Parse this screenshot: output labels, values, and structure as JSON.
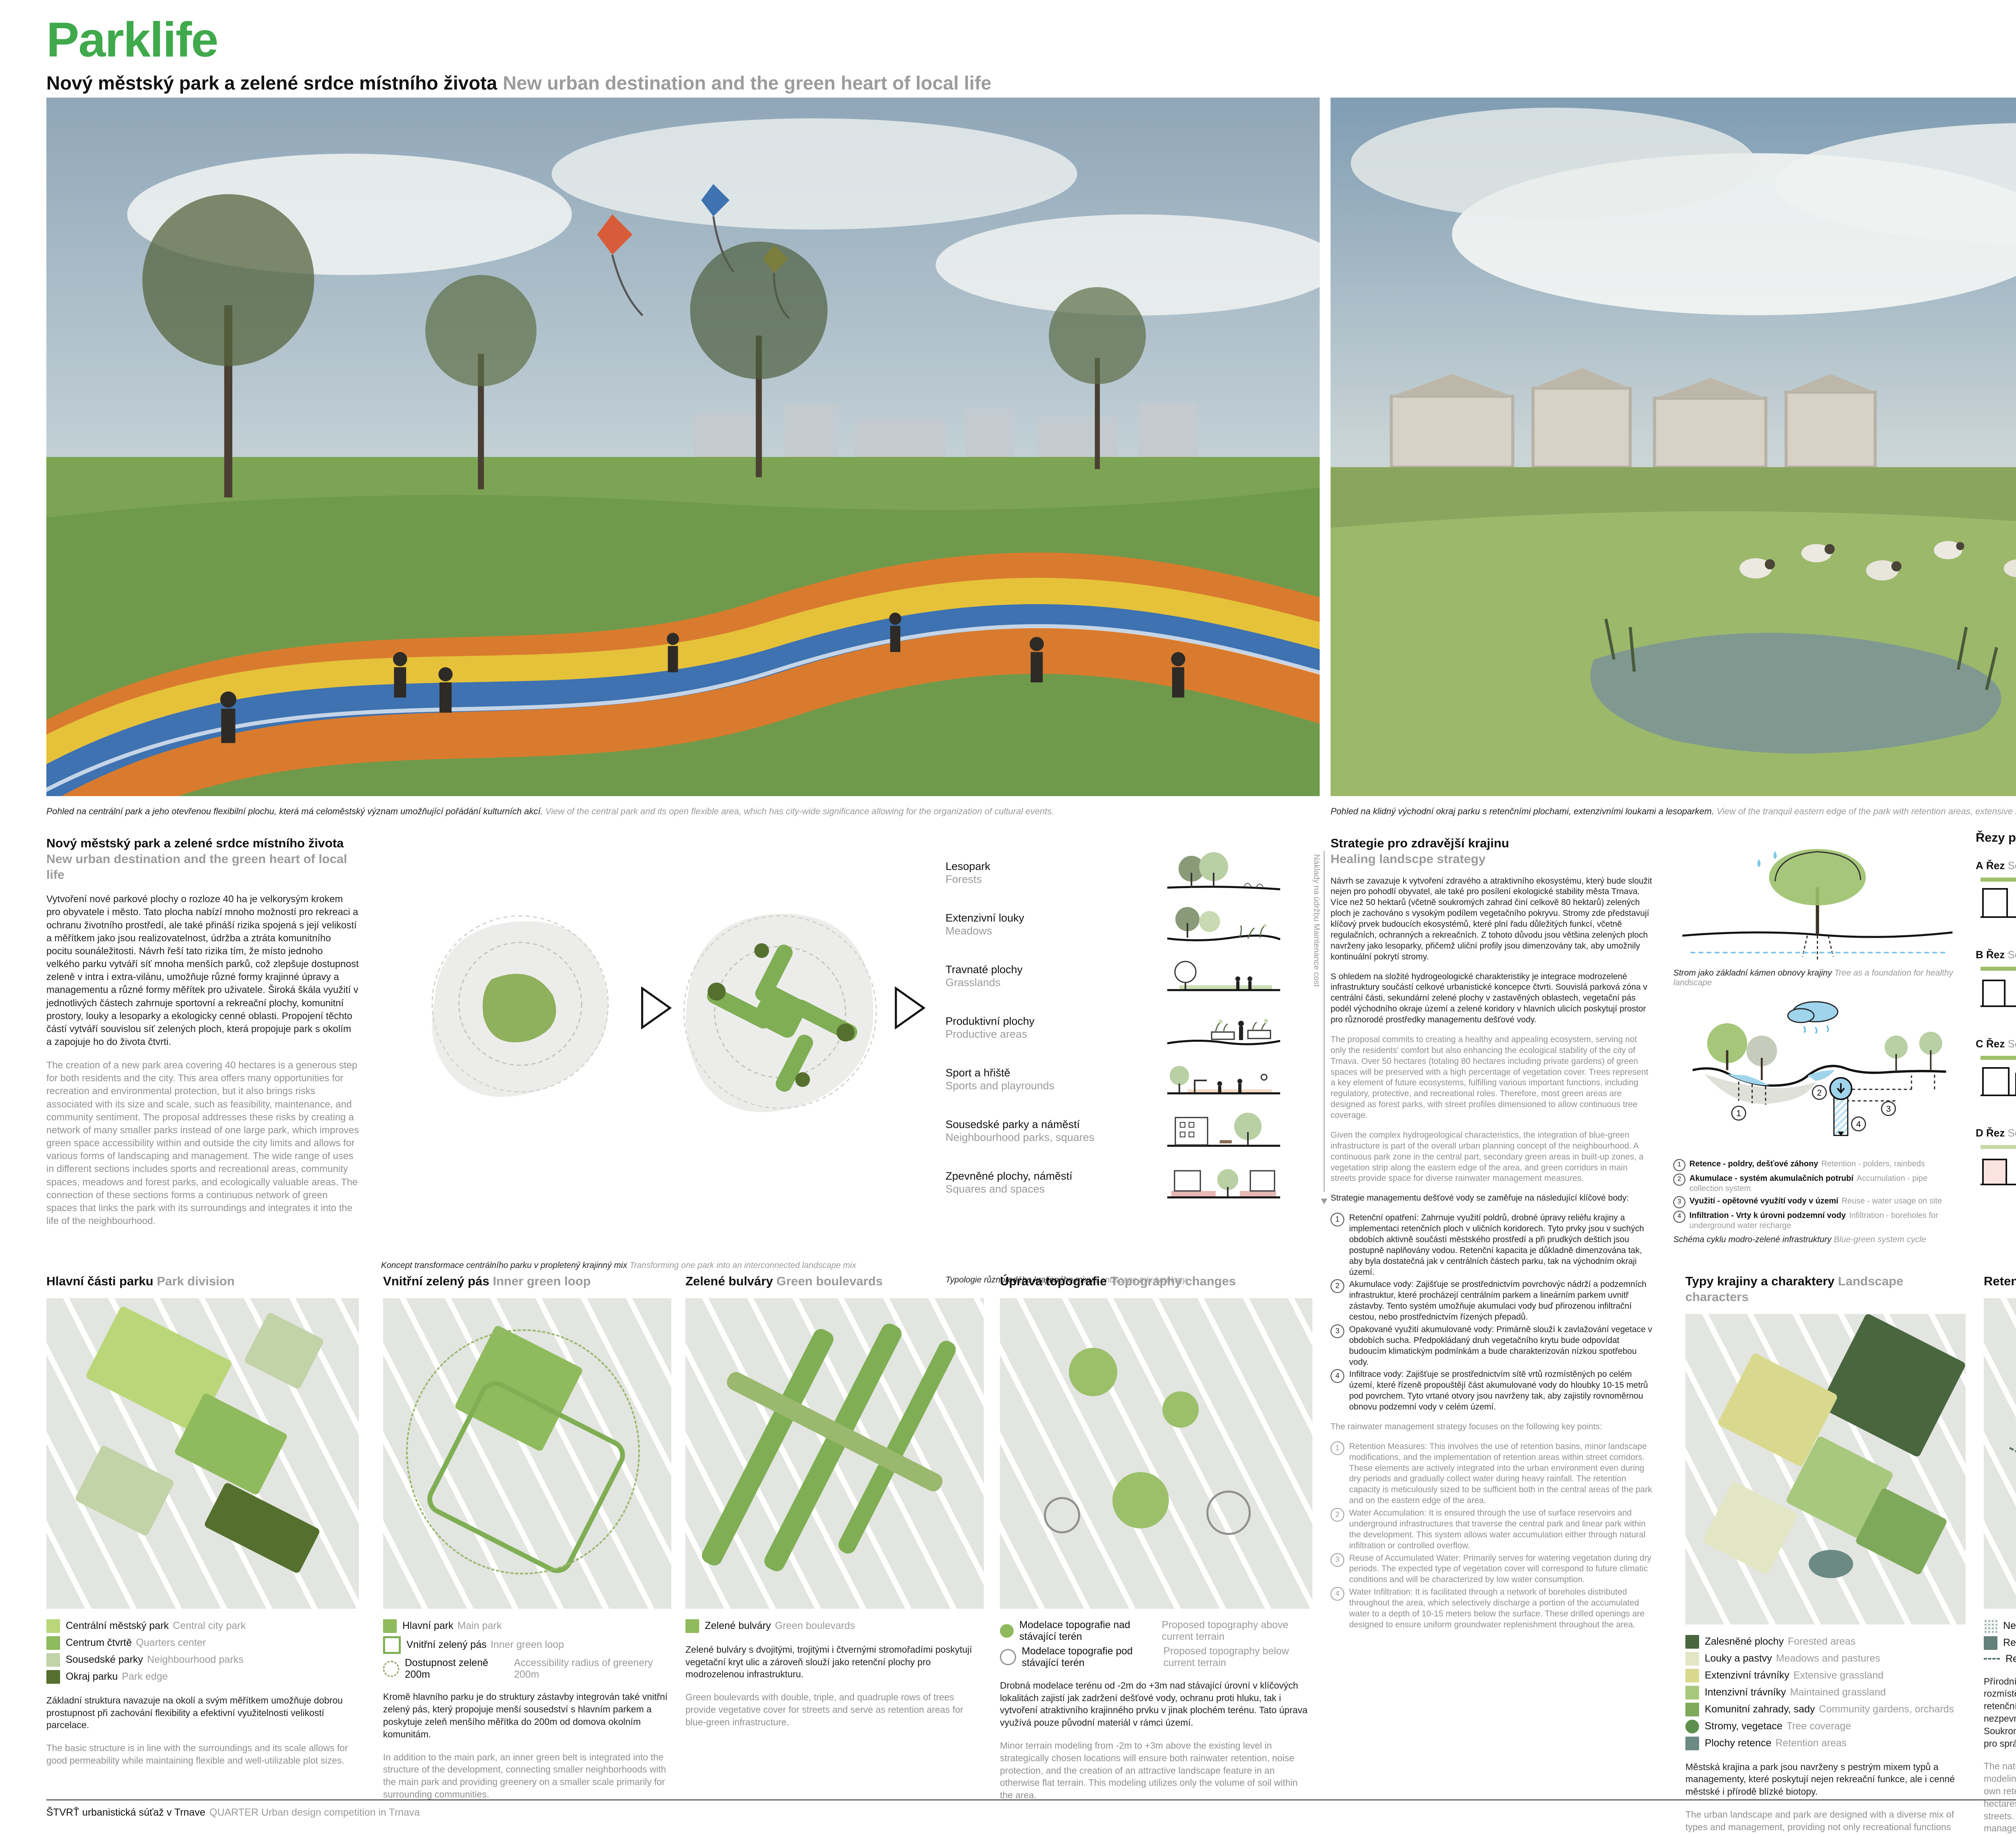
{
  "page": {
    "title": "Parklife",
    "page_number": "4/6",
    "subtitle_cz": "Nový městský park a zelené srdce místního života",
    "subtitle_en": "New urban destination and the green heart of local life"
  },
  "colors": {
    "accent_green": "#3fa94b",
    "park_light": "#b9d778",
    "park_mid": "#8fba5d",
    "park_pale": "#c2d3a8",
    "park_dark": "#55702e",
    "retention_teal": "#64807a",
    "water_blue": "#9fd4ec"
  },
  "hero": {
    "left_caption_cz": "Pohled na centrální park a jeho otevřenou flexibilní plochu, která má celoměstský význam umožňující pořádání kulturních akcí.",
    "left_caption_en": "View of the central park and its open flexible area, which has city-wide significance allowing for the organization of cultural events.",
    "right_caption_cz": "Pohled na klidný východní okraj parku s retenčními plochami, extenzivními loukami a lesoparkem.",
    "right_caption_en": "View of the tranquil eastern edge of the park with retention areas, extensive meadows, and a forest park."
  },
  "intro": {
    "heading_cz": "Nový městský park a zelené srdce místního života",
    "heading_en": "New urban destination and the green heart of local life",
    "body_cz": "Vytvoření nové parkové plochy o rozloze 40 ha je velkorysým krokem pro obyvatele i město. Tato plocha nabízí mnoho možností pro rekreaci a ochranu životního prostředí, ale také přináší rizika spojená s její velikostí a měřítkem jako jsou realizovatelnost, údržba a ztráta komunitního pocitu sounáležitosti. Návrh řeší tato rizika tím, že místo jednoho velkého parku vytváří síť mnoha menších parků, což zlepšuje dostupnost zeleně v intra i extra-vilánu, umožňuje různé formy krajinné úpravy a managementu a různé formy měřítek pro uživatele. Široká škála využití v jednotlivých částech zahrnuje sportovní a rekreační plochy, komunitní prostory, louky a lesoparky a ekologicky cenné oblasti. Propojení těchto částí vytváří souvislou síť zelených ploch, která propojuje park s okolím a zapojuje ho do života čtvrti.",
    "body_en": "The creation of a new park area covering 40 hectares is a generous step for both residents and the city. This area offers many opportunities for recreation and environmental protection, but it also brings risks associated with its size and scale, such as feasibility, maintenance, and community sentiment. The proposal addresses these risks by creating a network of many smaller parks instead of one large park, which improves green space accessibility within and outside the city limits and allows for various forms of landscaping and management. The wide range of uses in different sections includes sports and recreational areas, community spaces, meadows and forest parks, and ecologically valuable areas. The connection of these sections forms a continuous network of green spaces that links the park with its surroundings and integrates it into the life of the neighbourhood."
  },
  "concept": {
    "caption_cz": "Koncept transformace centrálního parku v propletený krajinný mix",
    "caption_en": "Transforming one park into an interconnected landscape mix"
  },
  "typology": {
    "axis_cz": "Náklady na údržbu",
    "axis_en": "Maintenance cost",
    "caption_cz": "Typologie různorodého krajinného mixu",
    "caption_en": "Landscape mix typology",
    "items": [
      {
        "cz": "Lesopark",
        "en": "Forests"
      },
      {
        "cz": "Extenzivní louky",
        "en": "Meadows"
      },
      {
        "cz": "Travnaté plochy",
        "en": "Grasslands"
      },
      {
        "cz": "Produktivní plochy",
        "en": "Productive areas"
      },
      {
        "cz": "Sport a hřiště",
        "en": "Sports and playrounds"
      },
      {
        "cz": "Sousedské parky a náměstí",
        "en": "Neighbourhood parks, squares"
      },
      {
        "cz": "Zpevněné plochy, náměstí",
        "en": "Squares and spaces"
      }
    ]
  },
  "strategy": {
    "heading_cz": "Strategie pro zdravější krajinu",
    "heading_en": "Healing landscpe strategy",
    "p1_cz": "Návrh se zavazuje k vytvoření zdravého a atraktivního ekosystému, který bude sloužit nejen pro pohodlí obyvatel, ale také pro posílení ekologické stability města Trnava. Více než 50 hektarů (včetně soukromých zahrad činí celkově 80 hektarů) zelených ploch je zachováno s vysokým podílem vegetačního pokryvu. Stromy zde představují klíčový prvek budoucích ekosystémů, které plní řadu důležitých funkcí, včetně regulačních, ochranných a rekreačních. Z tohoto důvodu jsou většina zelených ploch navrženy jako lesoparky, přičemž uliční profily jsou dimenzovány tak, aby umožnily kontinuální pokrytí stromy.",
    "p2_cz": "S ohledem na složité hydrogeologické charakteristiky je integrace modrozelené infrastruktury součástí celkové urbanistické koncepce čtvrti. Souvislá parková zóna v centrální části, sekundární zelené plochy v zastavěných oblastech, vegetační pás podél východního okraje území a zelené koridory v hlavních ulicích poskytují prostor pro různorodé prostředky managementu dešťové vody.",
    "p1_en": "The proposal commits to creating a healthy and appealing ecosystem, serving not only the residents' comfort but also enhancing the ecological stability of the city of Trnava. Over 50 hectares (totaling 80 hectares including private gardens) of green spaces will be preserved with a high percentage of vegetation cover. Trees represent a key element of future ecosystems, fulfilling various important functions, including regulatory, protective, and recreational roles. Therefore, most green areas are designed as forest parks, with street profiles dimensioned to allow continuous tree coverage.",
    "p2_en": "Given the complex hydrogeological characteristics, the integration of blue-green infrastructure is part of the overall urban planning concept of the neighbourhood. A continuous park zone in the central part, secondary green areas in built-up zones, a vegetation strip along the eastern edge of the area, and green corridors in main streets provide space for diverse rainwater management measures.",
    "list_intro_cz": "Strategie managementu dešťové vody se zaměřuje na následující klíčové body:",
    "list_intro_en": "The rainwater management strategy focuses on the following key points:",
    "list_cz": [
      {
        "num": "1",
        "text": "Retenční opatření: Zahrnuje využití poldrů, drobné úpravy reliéfu krajiny a implementaci retenčních ploch v uličních koridorech. Tyto prvky jsou v suchých obdobích aktivně součástí městského prostředí a při prudkých deštích jsou postupně naplňovány vodou. Retenční kapacita je důkladně dimenzována tak, aby byla dostatečná jak v centrálních částech parku, tak na východním okraji území."
      },
      {
        "num": "2",
        "text": "Akumulace vody: Zajišťuje se prostřednictvím povrchovýc nádrží a podzemních infrastruktur, které procházejí centrálním parkem a lineárním parkem uvnitř zástavby. Tento systém umožňuje akumulaci vody buď přirozenou infiltrační cestou, nebo prostřednictvím řízených přepadů."
      },
      {
        "num": "3",
        "text": "Opakované využití akumulované vody: Primárně slouží k zavlažování vegetace v obdobích sucha. Předpokládaný druh vegetačního krytu bude odpovídat budoucím klimatickým podmínkám a bude charakterizován nízkou spotřebou vody."
      },
      {
        "num": "4",
        "text": "Infiltrace vody: Zajišťuje se prostřednictvím sítě vrtů rozmístěných po celém území, které řízeně propouštějí část akumulované vody do hloubky 10-15 metrů pod povrchem. Tyto vrtané otvory jsou navrženy tak, aby zajistily rovnoměrnou obnovu podzemní vody v celém území."
      }
    ],
    "list_en": [
      {
        "num": "1",
        "text": "Retention Measures: This involves the use of retention basins, minor landscape modifications, and the implementation of retention areas within street corridors. These elements are actively integrated into the urban environment even during dry periods and gradually collect water during heavy rainfall. The retention capacity is meticulously sized to be sufficient both in the central areas of the park and on the eastern edge of the area."
      },
      {
        "num": "2",
        "text": "Water Accumulation: It is ensured through the use of surface reservoirs and underground infrastructures that traverse the central park and linear park within the development. This system allows water accumulation either through natural infiltration or controlled overflow."
      },
      {
        "num": "3",
        "text": "Reuse of Accumulated Water: Primarily serves for watering vegetation during dry periods. The expected type of vegetation cover will correspond to future climatic conditions and will be characterized by low water consumption."
      },
      {
        "num": "4",
        "text": "Water Infiltration: It is facilitated through a network of boreholes distributed throughout the area, which selectively discharge a portion of the accumulated water to a depth of 10-15 meters below the surface. These drilled openings are designed to ensure uniform groundwater replenishment throughout the area."
      }
    ]
  },
  "tree": {
    "caption_cz": "Strom jako základní kámen obnovy krajiny",
    "caption_en": "Tree as a foundation for healthy landscape"
  },
  "cycle": {
    "caption_cz": "Schéma cyklu modro-zelené infrastruktury",
    "caption_en": "Blue-green system cycle",
    "items": [
      {
        "num": "1",
        "cz": "Retence - poldry, dešťové záhony",
        "en": "Retention - polders, rainbeds"
      },
      {
        "num": "2",
        "cz": "Akumulace - systém akumulačních potrubí",
        "en": "Accumulation - pipe collection system"
      },
      {
        "num": "3",
        "cz": "Využití - opětovné využítí vody v území",
        "en": "Reuse - water usage on site"
      },
      {
        "num": "4",
        "cz": "Infiltration - Vrty k úrovni podzemní vody",
        "en": "Infiltration - boreholes for underground water recharge"
      }
    ]
  },
  "sections": {
    "heading_cz": "Řezy parkem",
    "heading_en": "Park sections 1:000",
    "note_cz": "Umístění značeno na hlavním masterplanu",
    "note_en": "Placement shown on masterplan",
    "rows": [
      {
        "letter": "A",
        "cz": "Řez",
        "en": "Section"
      },
      {
        "letter": "B",
        "cz": "Řez",
        "en": "Section"
      },
      {
        "letter": "C",
        "cz": "Řez",
        "en": "Section"
      },
      {
        "letter": "D",
        "cz": "Řez",
        "en": "Section"
      }
    ]
  },
  "bottom": {
    "col1": {
      "heading_cz": "Hlavní části parku",
      "heading_en": "Park division",
      "legend": [
        {
          "color": "#b9d778",
          "cz": "Centrální městský park",
          "en": "Central city park"
        },
        {
          "color": "#8fba5d",
          "cz": "Centrum čtvrtě",
          "en": "Quarters center"
        },
        {
          "color": "#c2d3a8",
          "cz": "Sousedské parky",
          "en": "Neighbourhood parks"
        },
        {
          "color": "#55702e",
          "cz": "Okraj parku",
          "en": "Park edge"
        }
      ],
      "body_cz": "Základní struktura navazuje na okolí a svým měřítkem umožňuje dobrou prostupnost při zachování flexibility a efektivní využitelnosti velikostí parcelace.",
      "body_en": "The basic structure is in line with the surroundings and its scale allows for good permeability while maintaining flexible and well-utilizable plot sizes."
    },
    "col2": {
      "heading_cz": "Vnitřní zelený pás",
      "heading_en": "Inner green loop",
      "legend": [
        {
          "color": "#8fba5d",
          "cz": "Hlavní park",
          "en": "Main park"
        },
        {
          "color": "outline",
          "cz": "Vnitřní zelený pás",
          "en": "Inner green loop"
        },
        {
          "color": "dashed",
          "cz": "Dostupnost zeleně 200m",
          "en": "Accessibility radius of greenery 200m"
        }
      ],
      "body_cz": "Kromě hlavního parku je do struktury zástavby integrován také vnitřní zelený pás, který propojuje menší sousedství s hlavním parkem a poskytuje zeleň menšího měřítka do 200m od domova okolním komunitám.",
      "body_en": "In addition to the main park, an inner green belt is integrated into the structure of the development, connecting smaller neighborhoods with the main park and providing greenery on a smaller scale primarily for surrounding communities."
    },
    "col3": {
      "heading_cz": "Zelené bulváry",
      "heading_en": "Green boulevards",
      "legend": [
        {
          "color": "#8fba5d",
          "cz": "Zelené bulváry",
          "en": "Green boulevards"
        }
      ],
      "body_cz": "Zelené bulváry s dvojitými, trojitými i čtvernými stromořadími poskytují vegetační kryt ulic a zároveň slouží jako retenční plochy pro modrozelenou infrastrukturu.",
      "body_en": "Green boulevards with double, triple, and quadruple rows of trees provide vegetative cover for streets and serve as retention areas for blue-green infrastructure."
    },
    "col4": {
      "heading_cz": "Úprava topografie",
      "heading_en": "Topography changes",
      "legend": [
        {
          "color": "#8fba5d",
          "cz": "Modelace topografie nad stávající terén",
          "en": "Proposed topography above current terrain"
        },
        {
          "color": "outline-circle",
          "cz": "Modelace topografie pod stávající terén",
          "en": "Proposed topography below current terrain"
        }
      ],
      "body_cz": "Drobná modelace terénu od -2m do +3m nad stávající úrovní v klíčových lokalitách zajistí jak zadržení dešťové vody, ochranu proti hluku, tak i vytvoření atraktivního krajinného prvku v jinak plochém terénu. Tato úprava využívá pouze původní materiál v rámci území.",
      "body_en": "Minor terrain modeling from -2m to +3m above the existing level in strategically chosen locations will ensure both rainwater retention, noise protection, and the creation of an attractive landscape feature in an otherwise flat terrain. This modeling utilizes only the volume of soil within the area."
    },
    "col5": {
      "heading_cz": "Typy krajiny a charaktery",
      "heading_en": "Landscape characters",
      "legend": [
        {
          "color": "#49663f",
          "cz": "Zalesněné plochy",
          "en": "Forested areas"
        },
        {
          "color": "#e3e6c3",
          "cz": "Louky a pastvy",
          "en": "Meadows and pastures"
        },
        {
          "color": "#d9d98e",
          "cz": "Extenzivní trávníky",
          "en": "Extensive grassland"
        },
        {
          "color": "#a8c87e",
          "cz": "Intenzivní trávníky",
          "en": "Maintained grassland"
        },
        {
          "color": "#7fa95a",
          "cz": "Komunitní zahrady, sady",
          "en": "Community gardens, orchards"
        },
        {
          "color": "#5d8f4e",
          "cz": "Stromy, vegetace",
          "en": "Tree coverage"
        },
        {
          "color": "#6b8a84",
          "cz": "Plochy retence",
          "en": "Retention areas"
        }
      ],
      "body_cz": "Městská krajina a park jsou navrženy s pestrým mixem typů a managementy, které poskytují nejen rekreační funkce, ale i cenné městské i přírodě blízké biotopy.",
      "body_en": "The urban landscape and park are designed with a diverse mix of types and management, providing not only recreational functions but also valuable urban and nature-like biotopes."
    },
    "col6": {
      "heading_cz": "Retenční plochy",
      "heading_en": "Retention areas",
      "legend": [
        {
          "color": "dots",
          "cz": "Nezpevněné plochy",
          "en": "Permeable areas"
        },
        {
          "color": "#64807a",
          "cz": "Retenční plochy",
          "en": "Retention areas, polders"
        },
        {
          "color": "dashline",
          "cz": "Retence v uličním profilu",
          "en": "Street retention areas"
        }
      ],
      "body_cz": "Přírodní systém retenčních oblastí tvořených poldy a modelací terénu je rozmístěn v zelených plochách území. Uliční profily mají vlastní systém retenčních záhonů. Kapacita zajišťuje retenci z 50ha veřejných nezpevněných ploch i 30ha ploch veřejných prostranství a ulic. Soukromé parcely a pozemky jsou dimenzované pro vlastní systémy pro správu dešťové vody.",
      "body_en": "The natural retention system consisting of floodplains and terrain modeling is distributed across green areas. Street profiles have their own retention beds system. The capacity ensures retention from 50 hectares of public unpaved areas and 30 hectares of public spaces and streets. Private plots and land will have their own rainwater management systems."
    },
    "col7": {
      "heading_cz": "Akumulační a infiltrační systém",
      "heading_en": "Accumulation and infiltration",
      "legend": [
        {
          "color": "solidline",
          "cz": "Akumulační potrubí",
          "en": "Ac accumulation pipe system"
        },
        {
          "color": "bore",
          "cz": "Vrty",
          "en": "Boreholes"
        }
      ],
      "body_cz": "Akumulační a infiltrační systém je tvořen akumulačním potrubím napojeným na retenční oblasti. Napříč územím jsou rovnoměrně umístěné vrty, které z akumulačního potrubí infiltrují vodo do hloubky.",
      "body_en": "The accumulation and infiltration system consist of accumulation pipelines connected to retention areas. Across the territory, evenly spaced wells are installed, which infiltrate water from the accumulation pipelines into the ground."
    }
  },
  "footer": {
    "cz": "ŠTVRŤ urbanistická súťaž v Trnave",
    "en": "QUARTER Urban design competition in Trnava"
  }
}
